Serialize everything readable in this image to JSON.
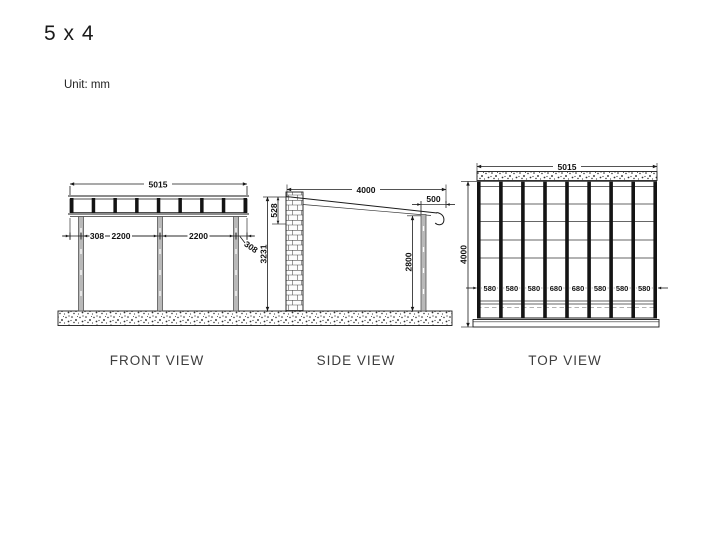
{
  "title": "5 x 4",
  "unit_label": "Unit: mm",
  "views": {
    "front": {
      "label": "FRONT VIEW",
      "total_width": "5015",
      "seg_left": "308",
      "seg_bay1": "2200",
      "seg_bay2": "2200",
      "seg_right": "308"
    },
    "side": {
      "label": "SIDE VIEW",
      "roof_length": "4000",
      "overhang": "500",
      "roof_drop": "528",
      "wall_height": "3231",
      "post_height": "2800"
    },
    "top": {
      "label": "TOP VIEW",
      "total_width": "5015",
      "total_depth": "4000",
      "bays": [
        "580",
        "580",
        "580",
        "680",
        "680",
        "580",
        "580",
        "580"
      ]
    }
  }
}
